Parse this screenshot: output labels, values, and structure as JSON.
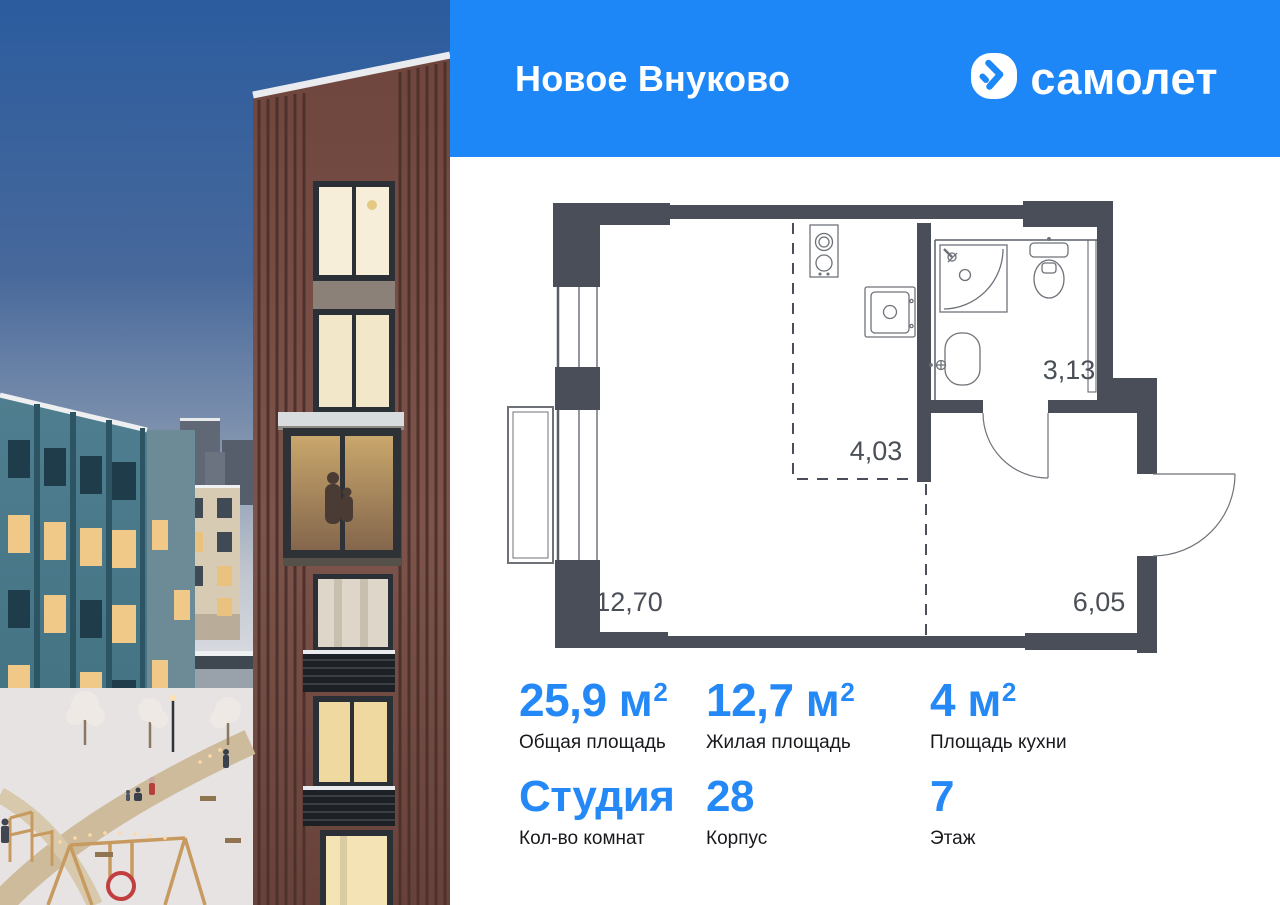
{
  "header": {
    "title": "Новое Внуково",
    "brand": "самолет"
  },
  "floor_plan": {
    "living_area": "12,70",
    "kitchen_area": "4,03",
    "bathroom_area": "3,13",
    "hallway_area": "6,05"
  },
  "stats": {
    "row1": [
      {
        "value": "25,9",
        "unit": " м",
        "sup": "2",
        "label": "Общая площадь"
      },
      {
        "value": "12,7",
        "unit": " м",
        "sup": "2",
        "label": "Жилая площадь"
      },
      {
        "value": "4",
        "unit": " м",
        "sup": "2",
        "label": "Площадь кухни"
      }
    ],
    "row2": [
      {
        "value": "Студия",
        "unit": "",
        "sup": "",
        "label": "Кол-во комнат"
      },
      {
        "value": "28",
        "unit": "",
        "sup": "",
        "label": "Корпус"
      },
      {
        "value": "7",
        "unit": "",
        "sup": "",
        "label": "Этаж"
      }
    ]
  },
  "icons": {
    "logo": "samolet-arrow-icon"
  },
  "colors": {
    "accent": "#1E87F7",
    "stat_number": "#2489F6",
    "plan_wall": "#4A4E59",
    "plan_text": "#4B4F58",
    "text_dark": "#17191D"
  }
}
